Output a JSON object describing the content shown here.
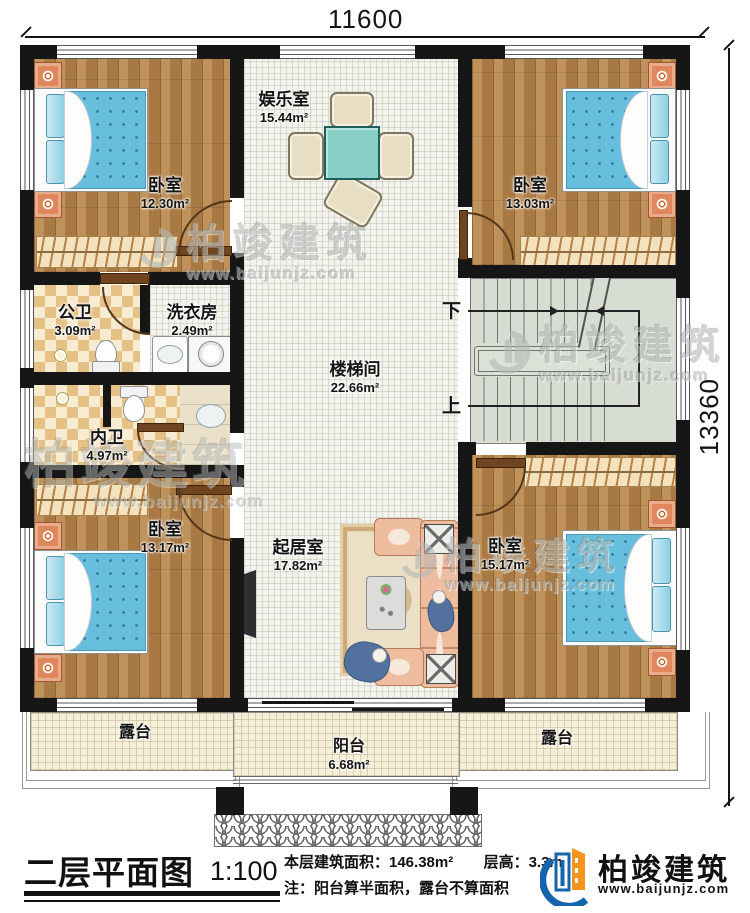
{
  "dimensions": {
    "top": "11600",
    "right": "13360"
  },
  "rooms": {
    "bedroom_tl": {
      "name": "卧室",
      "area": "12.30m²"
    },
    "entertainment": {
      "name": "娱乐室",
      "area": "15.44m²"
    },
    "bedroom_tr": {
      "name": "卧室",
      "area": "13.03m²"
    },
    "public_bath": {
      "name": "公卫",
      "area": "3.09m²"
    },
    "laundry": {
      "name": "洗衣房",
      "area": "2.49m²"
    },
    "stairwell": {
      "name": "楼梯间",
      "area": "22.66m²"
    },
    "private_bath": {
      "name": "内卫",
      "area": "4.97m²"
    },
    "bedroom_bl": {
      "name": "卧室",
      "area": "13.17m²"
    },
    "living": {
      "name": "起居室",
      "area": "17.82m²"
    },
    "bedroom_br": {
      "name": "卧室",
      "area": "15.17m²"
    },
    "terrace_left": {
      "name": "露台"
    },
    "balcony": {
      "name": "阳台",
      "area": "6.68m²"
    },
    "terrace_right": {
      "name": "露台"
    }
  },
  "stairs": {
    "down_label": "下",
    "up_label": "上"
  },
  "footer": {
    "title": "二层平面图",
    "scale": "1:100",
    "area_text": "本层建筑面积：146.38m²",
    "floor_height_text": "层高：3.3m",
    "note_text": "注：阳台算半面积，露台不算面积",
    "brand": "柏竣建筑",
    "website": "www.baijunjz.com"
  },
  "watermark": {
    "brand": "柏竣建筑",
    "site": "www.baijunjz.com"
  },
  "colors": {
    "wall": "#161616",
    "wood_floor": "#b5834a",
    "bed_blanket": "#68bedd",
    "checker_tile": "#e5c186",
    "stair_floor": "#d8ddd4",
    "terrace_floor": "#f5efda",
    "nightstand_orange": "#e0875c",
    "logo_blue": "#1565ad",
    "logo_orange": "#f7941d"
  }
}
